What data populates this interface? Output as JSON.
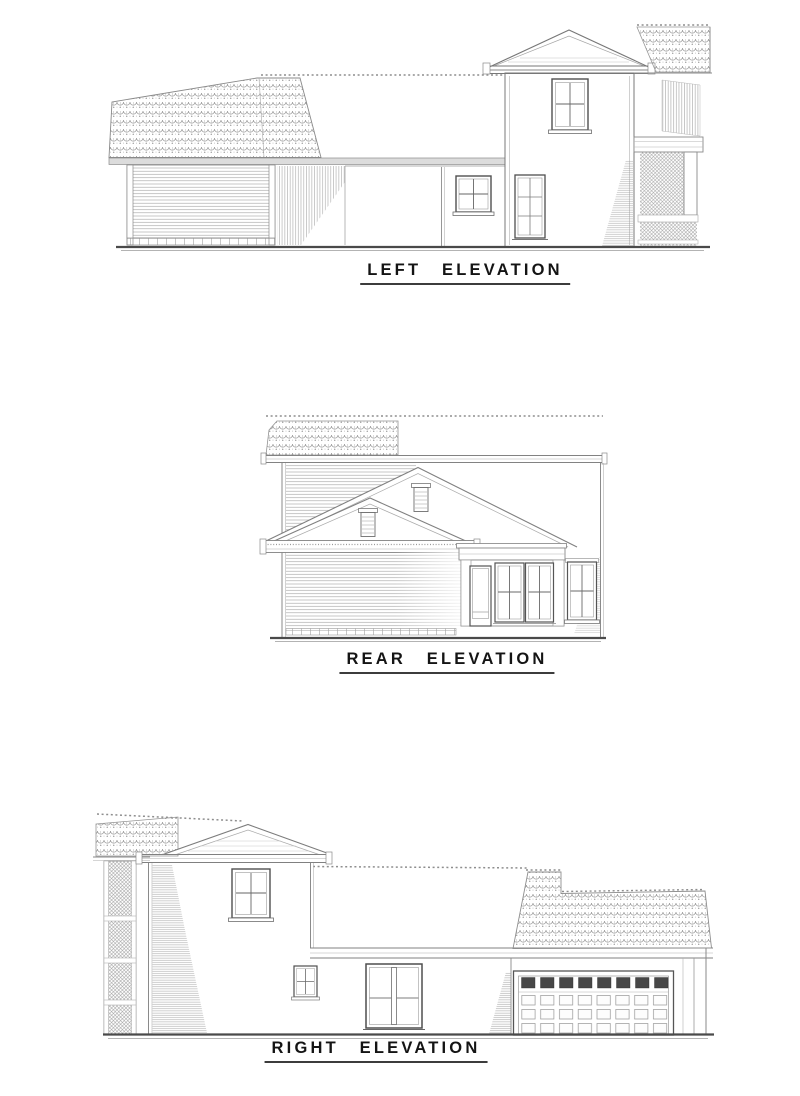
{
  "page": {
    "background": "#ffffff",
    "line_color": "#808080",
    "label_color": "#141414",
    "underline_color": "#3c3c3c"
  },
  "drawings": [
    {
      "id": "left-elevation",
      "label": "LEFT ELEVATION"
    },
    {
      "id": "rear-elevation",
      "label": "REAR ELEVATION"
    },
    {
      "id": "right-elevation",
      "label": "RIGHT ELEVATION"
    }
  ]
}
